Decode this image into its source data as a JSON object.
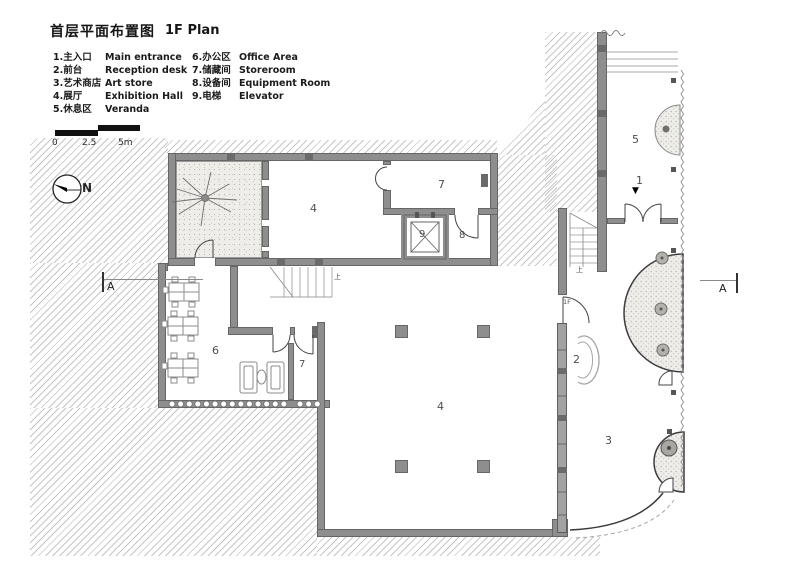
{
  "title": {
    "zh": "首层平面布置图",
    "en": "1F  Plan"
  },
  "legend": {
    "items_left": [
      {
        "zh": "1.主入口",
        "en": "Main entrance"
      },
      {
        "zh": "2.前台",
        "en": "Reception desk"
      },
      {
        "zh": "3.艺术商店",
        "en": "Art store"
      },
      {
        "zh": "4.展厅",
        "en": "Exhibition Hall"
      },
      {
        "zh": "5.休息区",
        "en": "Veranda"
      }
    ],
    "items_right": [
      {
        "zh": "6.办公区",
        "en": "Office Area"
      },
      {
        "zh": "7.储藏间",
        "en": "Storeroom"
      },
      {
        "zh": "8.设备间",
        "en": "Equipment Room"
      },
      {
        "zh": "9.电梯",
        "en": "Elevator"
      }
    ]
  },
  "scale_bar": {
    "t0": "0",
    "t1": "2.5",
    "t2": "5m"
  },
  "north_label": "N",
  "section_label": "A",
  "rooms": {
    "main_entrance": "1",
    "reception": "2",
    "art_store": "3",
    "exhibition": "4",
    "veranda": "5",
    "office": "6",
    "storeroom": "7",
    "equipment": "8",
    "elevator": "9"
  },
  "annotations": {
    "stair_up": "上",
    "level_1f": "1F",
    "entrance_arrow": "▼"
  },
  "colors": {
    "wall": "#8e8e8e",
    "wall_dark": "#6a6a6a",
    "line": "#555555",
    "hatch": "#828282",
    "stipple_bg": "#efede9"
  }
}
